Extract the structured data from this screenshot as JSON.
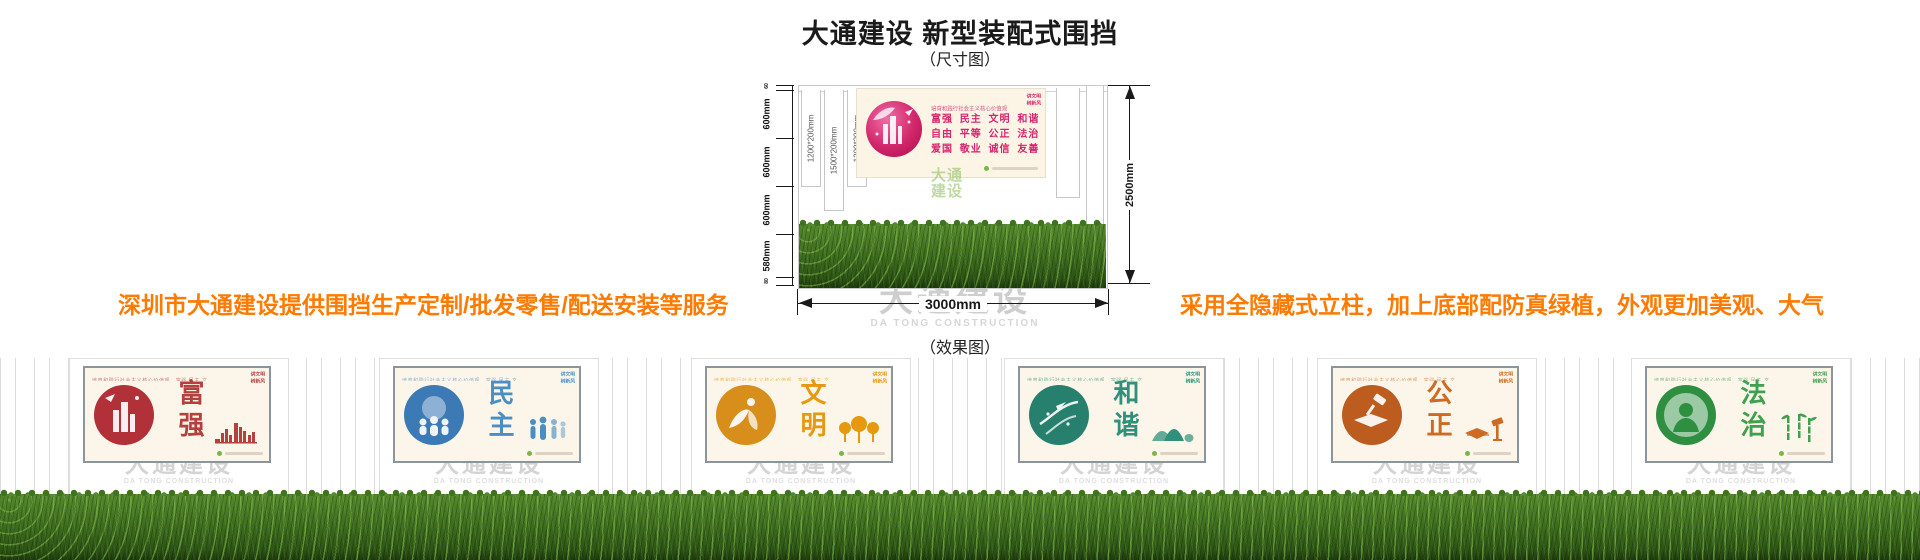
{
  "header": {
    "title": "大通建设 新型装配式围挡",
    "size_caption": "（尺寸图）",
    "effect_caption": "（效果图）"
  },
  "promo": {
    "left_text": "深圳市大通建设提供围挡生产定制/批发零售/配送安装等服务",
    "right_text": "采用全隐藏式立柱，加上底部配防真绿植，外观更加美观、大气",
    "color": "#ff7a00"
  },
  "watermark": {
    "text": "大通建设",
    "subtext": "DA TONG CONSTRUCTION"
  },
  "dimension_diagram": {
    "height_segments": [
      {
        "label": "60"
      },
      {
        "label": "600mm"
      },
      {
        "label": "600mm"
      },
      {
        "label": "600mm"
      },
      {
        "label": "580mm"
      },
      {
        "label": "80"
      }
    ],
    "column_sizes": [
      "1200*200mm",
      "1500*200mm",
      "1200*200mm"
    ],
    "total_height_label": "2500mm",
    "total_width_label": "3000mm",
    "poster": {
      "heading": "培育和践行社会主义核心价值观",
      "value_rows": [
        "富强 民主 文明 和谐",
        "自由 平等 公正 法治",
        "爱国 敬业 诚信 友善"
      ],
      "badge_lines": [
        "讲文明",
        "树新风"
      ],
      "accent": "#d6246e"
    },
    "logo_lines": [
      "大通",
      "建设"
    ],
    "logo_color": "#7ab648"
  },
  "effect_view": {
    "panel_top_strip": "培育和践行社会主义核心价值观　富强 民主 文明 和谐 自由 平等 公正 法治 爱国 敬业 诚信 友善",
    "panel_badge_lines": [
      "讲文明",
      "树新风"
    ],
    "panels": [
      {
        "name": "富强",
        "accent": "#b5403e",
        "circle": "#b23038",
        "circle_light": "#e4848e",
        "art": "qiang",
        "motif": "city-skyline"
      },
      {
        "name": "民主",
        "accent": "#4a8fc4",
        "circle": "#3c7ab5",
        "circle_light": "#9cc4e0",
        "art": "min",
        "motif": "people"
      },
      {
        "name": "文明",
        "accent": "#e6980f",
        "circle": "#d88e1a",
        "circle_light": "#f3c878",
        "art": "wen",
        "motif": "trees"
      },
      {
        "name": "和谐",
        "accent": "#30907b",
        "circle": "#27806d",
        "circle_light": "#8bc7b4",
        "art": "he",
        "motif": "mountains"
      },
      {
        "name": "公正",
        "accent": "#cd6a23",
        "circle": "#bd5c1f",
        "circle_light": "#e8a468",
        "art": "gong",
        "motif": "book-gavel"
      },
      {
        "name": "法治",
        "accent": "#3fa04d",
        "circle": "#2f8f41",
        "circle_light": "#93cf92",
        "art": "fa",
        "motif": "bamboo"
      }
    ]
  }
}
